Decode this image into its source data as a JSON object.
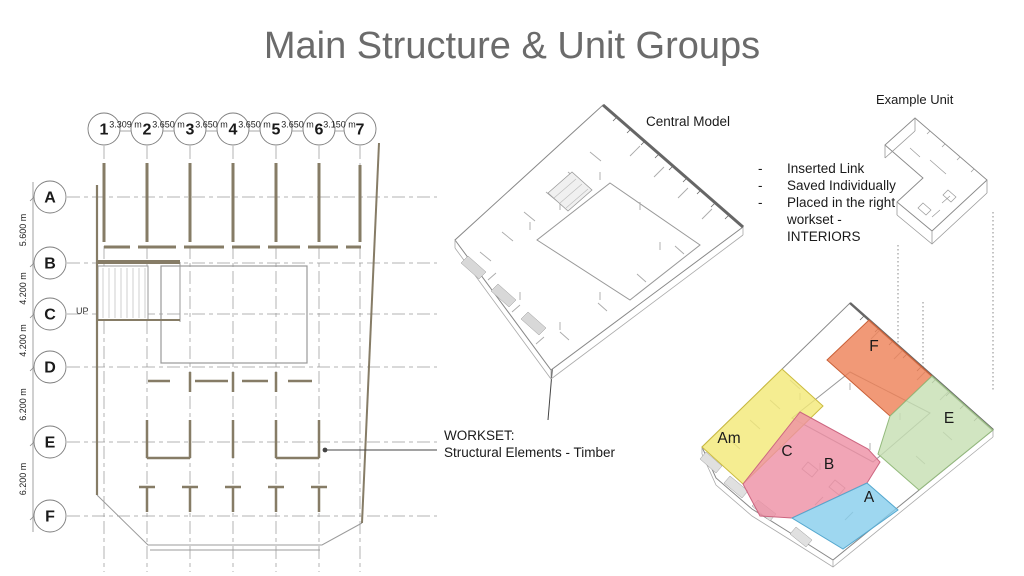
{
  "slide": {
    "title": "Main Structure & Unit Groups"
  },
  "floor_plan": {
    "column_bubbles": [
      "1",
      "2",
      "3",
      "4",
      "5",
      "6",
      "7"
    ],
    "column_dims": [
      "3.309 m",
      "3.650 m",
      "3.650 m",
      "3.650 m",
      "3.650 m",
      "3.150 m"
    ],
    "row_bubbles": [
      "A",
      "B",
      "C",
      "D",
      "E",
      "F"
    ],
    "row_dims": [
      "5.600 m",
      "4.200 m",
      "4.200 m",
      "6.200 m",
      "6.200 m"
    ],
    "stair_label": "UP"
  },
  "central_model": {
    "label": "Central Model",
    "workset_title": "WORKSET:",
    "workset_name": "Structural Elements - Timber"
  },
  "link_notes": [
    "Inserted Link",
    "Saved Individually",
    "Placed in the right workset - INTERIORS"
  ],
  "example_unit": {
    "label": "Example Unit"
  },
  "unit_groups": [
    {
      "label": "F",
      "color": "#ee7f55"
    },
    {
      "label": "E",
      "color": "#c6dfb2"
    },
    {
      "label": "Am",
      "color": "#f2e876"
    },
    {
      "label": "C",
      "color": "#ed8fa4"
    },
    {
      "label": "B",
      "color": "#ed8fa4"
    },
    {
      "label": "A",
      "color": "#86cdec"
    }
  ]
}
